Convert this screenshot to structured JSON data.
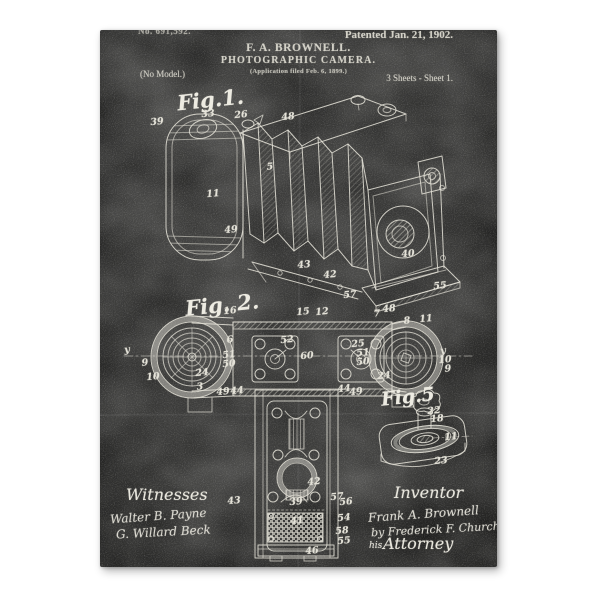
{
  "poster": {
    "header": {
      "patent_number": "No. 691,592.",
      "patented": "Patented Jan. 21, 1902.",
      "inventor_name": "F. A. BROWNELL.",
      "title": "PHOTOGRAPHIC CAMERA.",
      "application_line": "(Application filed Feb. 6, 1899.)",
      "no_model": "(No Model.)",
      "sheets": "3 Sheets - Sheet 1."
    },
    "figures": [
      {
        "id": "fig1",
        "label": "Fig.1.",
        "label_pos": {
          "x": 77,
          "y": 57
        },
        "refs": [
          {
            "t": "39",
            "x": 57,
            "y": 92
          },
          {
            "t": "33",
            "x": 108,
            "y": 84
          },
          {
            "t": "26",
            "x": 141,
            "y": 85
          },
          {
            "t": "48",
            "x": 188,
            "y": 87
          },
          {
            "t": "11",
            "x": 113,
            "y": 164
          },
          {
            "t": "5",
            "x": 170,
            "y": 137
          },
          {
            "t": "49",
            "x": 131,
            "y": 200
          },
          {
            "t": "43",
            "x": 204,
            "y": 235
          },
          {
            "t": "42",
            "x": 230,
            "y": 245
          },
          {
            "t": "40",
            "x": 308,
            "y": 224
          },
          {
            "t": "57",
            "x": 250,
            "y": 265
          },
          {
            "t": "55",
            "x": 340,
            "y": 256
          }
        ]
      },
      {
        "id": "fig2",
        "label": "Fig. 2.",
        "label_pos": {
          "x": 85,
          "y": 262
        },
        "refs": [
          {
            "t": "y",
            "x": 27,
            "y": 320
          },
          {
            "t": "9",
            "x": 45,
            "y": 333
          },
          {
            "t": "10",
            "x": 53,
            "y": 347
          },
          {
            "t": "24",
            "x": 102,
            "y": 343
          },
          {
            "t": "3",
            "x": 100,
            "y": 357
          },
          {
            "t": "16",
            "x": 130,
            "y": 281
          },
          {
            "t": "15",
            "x": 203,
            "y": 282
          },
          {
            "t": "12",
            "x": 222,
            "y": 282
          },
          {
            "t": "6",
            "x": 130,
            "y": 310
          },
          {
            "t": "51",
            "x": 129,
            "y": 325
          },
          {
            "t": "50",
            "x": 129,
            "y": 334
          },
          {
            "t": "52",
            "x": 187,
            "y": 310
          },
          {
            "t": "60",
            "x": 207,
            "y": 326
          },
          {
            "t": "25",
            "x": 258,
            "y": 314
          },
          {
            "t": "51",
            "x": 263,
            "y": 323
          },
          {
            "t": "50",
            "x": 263,
            "y": 332
          },
          {
            "t": "7",
            "x": 277,
            "y": 284
          },
          {
            "t": "48",
            "x": 289,
            "y": 279
          },
          {
            "t": "8",
            "x": 307,
            "y": 291
          },
          {
            "t": "11",
            "x": 326,
            "y": 289
          },
          {
            "t": "y",
            "x": 343,
            "y": 321
          },
          {
            "t": "10",
            "x": 345,
            "y": 330
          },
          {
            "t": "9",
            "x": 348,
            "y": 339
          },
          {
            "t": "24",
            "x": 284,
            "y": 346
          },
          {
            "t": "49",
            "x": 123,
            "y": 362
          },
          {
            "t": "44",
            "x": 137,
            "y": 361
          },
          {
            "t": "44",
            "x": 244,
            "y": 359
          },
          {
            "t": "49",
            "x": 256,
            "y": 362
          }
        ]
      },
      {
        "id": "section",
        "label": "",
        "refs": [
          {
            "t": "43",
            "x": 134,
            "y": 471
          },
          {
            "t": "42",
            "x": 214,
            "y": 452
          },
          {
            "t": "39",
            "x": 196,
            "y": 472
          },
          {
            "t": "41",
            "x": 197,
            "y": 491
          },
          {
            "t": "57",
            "x": 237,
            "y": 467
          },
          {
            "t": "56",
            "x": 246,
            "y": 472
          },
          {
            "t": "54",
            "x": 244,
            "y": 488
          },
          {
            "t": "58",
            "x": 242,
            "y": 501
          },
          {
            "t": "55",
            "x": 244,
            "y": 511
          },
          {
            "t": "46",
            "x": 212,
            "y": 521
          }
        ]
      },
      {
        "id": "fig5",
        "label": "Fig.5",
        "label_pos": {
          "x": 281,
          "y": 356
        },
        "refs": [
          {
            "t": "22",
            "x": 334,
            "y": 381
          },
          {
            "t": "18",
            "x": 337,
            "y": 389
          },
          {
            "t": "11",
            "x": 351,
            "y": 407
          },
          {
            "t": "23",
            "x": 341,
            "y": 431
          }
        ]
      }
    ],
    "footer": {
      "witnesses_label": "Witnesses",
      "witness_1": "Walter B. Payne",
      "witness_2": "G. Willard Beck",
      "inventor_label": "Inventor",
      "inventor_signature": "Frank A. Brownell",
      "attorney_signature": "by Frederick F. Church",
      "his_label": "his",
      "attorney_label": "Attorney"
    },
    "colors": {
      "poster_background": "#232322",
      "chalk_ink": "#e2e0d6",
      "page_background": "#ffffff"
    }
  }
}
